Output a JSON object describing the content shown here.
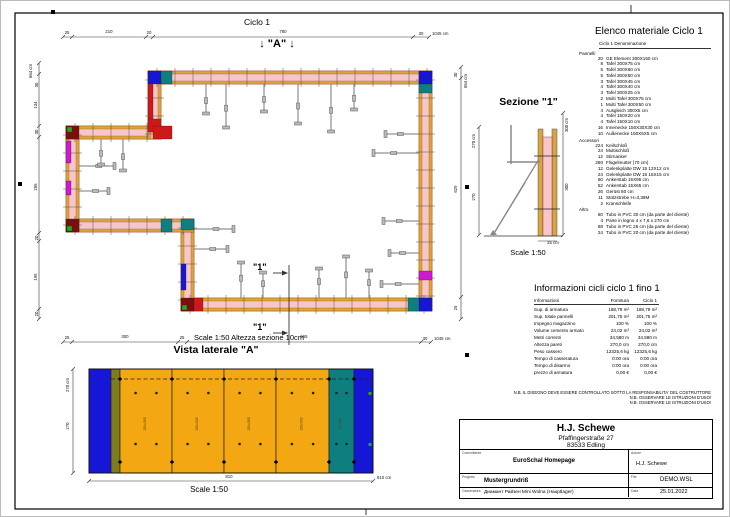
{
  "sheet": {
    "bg": "#ffffff",
    "frame_color": "#000000"
  },
  "plan": {
    "title": "Ciclo 1",
    "marker_a": "↓ \"A\" ↓",
    "cut_label": "\"1\"",
    "scale_note": "Scale 1:50   Altezza sezione 10cm",
    "colors": {
      "concrete": "#f7c6ca",
      "panel": "#e2a23b",
      "tick": "#555555"
    },
    "walls": [
      {
        "x": 147,
        "y": 70,
        "w": 284,
        "h": 13
      },
      {
        "x": 418,
        "y": 70,
        "w": 13,
        "h": 240
      },
      {
        "x": 180,
        "y": 297,
        "w": 251,
        "h": 13
      },
      {
        "x": 180,
        "y": 218,
        "w": 13,
        "h": 92
      },
      {
        "x": 65,
        "y": 218,
        "w": 128,
        "h": 13
      },
      {
        "x": 65,
        "y": 125,
        "w": 13,
        "h": 106
      },
      {
        "x": 65,
        "y": 125,
        "w": 95,
        "h": 13
      },
      {
        "x": 147,
        "y": 70,
        "w": 13,
        "h": 68
      }
    ],
    "corners": [
      {
        "x": 147,
        "y": 70,
        "w": 13,
        "h": 13,
        "c": "#1717d2"
      },
      {
        "x": 160,
        "y": 70,
        "w": 11,
        "h": 13,
        "c": "#0e7f7f"
      },
      {
        "x": 418,
        "y": 70,
        "w": 13,
        "h": 13,
        "c": "#1717d2"
      },
      {
        "x": 418,
        "y": 83,
        "w": 13,
        "h": 9,
        "c": "#0e7f7f"
      },
      {
        "x": 418,
        "y": 297,
        "w": 13,
        "h": 13,
        "c": "#1717d2"
      },
      {
        "x": 407,
        "y": 297,
        "w": 11,
        "h": 13,
        "c": "#0e7f7f"
      },
      {
        "x": 147,
        "y": 83,
        "w": 5,
        "h": 42,
        "c": "#d01818"
      },
      {
        "x": 147,
        "y": 118,
        "w": 13,
        "h": 13,
        "c": "#d01818"
      },
      {
        "x": 152,
        "y": 125,
        "w": 19,
        "h": 13,
        "c": "#d01818"
      },
      {
        "x": 65,
        "y": 125,
        "w": 13,
        "h": 13,
        "c": "#7e0d0d"
      },
      {
        "x": 66,
        "y": 126,
        "w": 5,
        "h": 5,
        "c": "#1faa1f"
      },
      {
        "x": 65,
        "y": 140,
        "w": 5,
        "h": 22,
        "c": "#d018d0"
      },
      {
        "x": 65,
        "y": 180,
        "w": 5,
        "h": 14,
        "c": "#d018d0"
      },
      {
        "x": 65,
        "y": 218,
        "w": 13,
        "h": 13,
        "c": "#7e0d0d"
      },
      {
        "x": 66,
        "y": 225,
        "w": 5,
        "h": 5,
        "c": "#1faa1f"
      },
      {
        "x": 180,
        "y": 218,
        "w": 13,
        "h": 11,
        "c": "#0e7f7f"
      },
      {
        "x": 160,
        "y": 218,
        "w": 11,
        "h": 13,
        "c": "#0e7f7f"
      },
      {
        "x": 180,
        "y": 263,
        "w": 5,
        "h": 26,
        "c": "#1717d2"
      },
      {
        "x": 180,
        "y": 297,
        "w": 13,
        "h": 13,
        "c": "#7e0d0d"
      },
      {
        "x": 181,
        "y": 304,
        "w": 5,
        "h": 5,
        "c": "#1faa1f"
      },
      {
        "x": 193,
        "y": 297,
        "w": 9,
        "h": 13,
        "c": "#d01818"
      },
      {
        "x": 418,
        "y": 270,
        "w": 13,
        "h": 9,
        "c": "#d018d0"
      }
    ],
    "props": [
      {
        "x": 205,
        "y": 83,
        "dir": "d",
        "len": 30
      },
      {
        "x": 225,
        "y": 83,
        "dir": "d",
        "len": 44
      },
      {
        "x": 263,
        "y": 83,
        "dir": "d",
        "len": 28
      },
      {
        "x": 297,
        "y": 83,
        "dir": "d",
        "len": 40
      },
      {
        "x": 330,
        "y": 83,
        "dir": "d",
        "len": 48
      },
      {
        "x": 353,
        "y": 83,
        "dir": "d",
        "len": 26
      },
      {
        "x": 418,
        "y": 133,
        "dir": "l",
        "len": 34
      },
      {
        "x": 418,
        "y": 152,
        "dir": "l",
        "len": 46
      },
      {
        "x": 418,
        "y": 220,
        "dir": "l",
        "len": 36
      },
      {
        "x": 418,
        "y": 252,
        "dir": "l",
        "len": 30
      },
      {
        "x": 418,
        "y": 283,
        "dir": "l",
        "len": 38
      },
      {
        "x": 240,
        "y": 297,
        "dir": "u",
        "len": 36
      },
      {
        "x": 262,
        "y": 297,
        "dir": "u",
        "len": 26
      },
      {
        "x": 318,
        "y": 297,
        "dir": "u",
        "len": 30
      },
      {
        "x": 345,
        "y": 297,
        "dir": "u",
        "len": 42
      },
      {
        "x": 368,
        "y": 297,
        "dir": "u",
        "len": 28
      },
      {
        "x": 78,
        "y": 165,
        "dir": "r",
        "len": 36
      },
      {
        "x": 78,
        "y": 190,
        "dir": "r",
        "len": 30
      },
      {
        "x": 100,
        "y": 138,
        "dir": "d",
        "len": 26
      },
      {
        "x": 122,
        "y": 138,
        "dir": "d",
        "len": 32
      },
      {
        "x": 193,
        "y": 228,
        "dir": "r",
        "len": 40
      },
      {
        "x": 193,
        "y": 248,
        "dir": "r",
        "len": 34
      }
    ],
    "dim_chains": [
      {
        "dir": "h",
        "x1": 62,
        "x2": 428,
        "y": 36,
        "ticks": [
          62,
          71,
          145,
          152,
          412,
          428
        ],
        "labels": [
          {
            "t": "25",
            "x": 66,
            "y": 33
          },
          {
            "t": "210",
            "x": 108,
            "y": 32
          },
          {
            "t": "20",
            "x": 148,
            "y": 33
          },
          {
            "t": "780",
            "x": 282,
            "y": 32
          },
          {
            "t": "30",
            "x": 420,
            "y": 34
          },
          {
            "t": "1045 cm",
            "x": 431,
            "y": 34,
            "anchor": "start"
          }
        ]
      },
      {
        "dir": "h",
        "x1": 62,
        "x2": 430,
        "y": 341,
        "ticks": [
          62,
          71,
          177,
          186,
          420,
          430
        ],
        "labels": [
          {
            "t": "25",
            "x": 66,
            "y": 338
          },
          {
            "t": "300",
            "x": 124,
            "y": 337
          },
          {
            "t": "25",
            "x": 181,
            "y": 338
          },
          {
            "t": "665",
            "x": 303,
            "y": 337
          },
          {
            "t": "30",
            "x": 424,
            "y": 339
          },
          {
            "t": "1045 cm",
            "x": 433,
            "y": 339,
            "anchor": "start"
          }
        ]
      },
      {
        "dir": "v",
        "x": 38,
        "y1": 62,
        "y2": 318,
        "ticks": [
          62,
          73,
          125,
          136,
          232,
          240,
          308,
          318
        ],
        "labels": [
          {
            "t": "664 cm",
            "x": 31,
            "y": 70
          },
          {
            "t": "30",
            "x": 37,
            "y": 84
          },
          {
            "t": "134",
            "x": 36,
            "y": 104
          },
          {
            "t": "30",
            "x": 37,
            "y": 131
          },
          {
            "t": "255",
            "x": 36,
            "y": 186
          },
          {
            "t": "20",
            "x": 37,
            "y": 237
          },
          {
            "t": "195",
            "x": 36,
            "y": 276
          },
          {
            "t": "20",
            "x": 37,
            "y": 313
          }
        ]
      },
      {
        "dir": "v",
        "x": 460,
        "y1": 66,
        "y2": 318,
        "ticks": [
          66,
          77,
          296,
          318
        ],
        "labels": [
          {
            "t": "654 cm",
            "x": 466,
            "y": 80
          },
          {
            "t": "30",
            "x": 456,
            "y": 74
          },
          {
            "t": "629",
            "x": 456,
            "y": 188
          },
          {
            "t": "25",
            "x": 456,
            "y": 307
          }
        ]
      }
    ],
    "cut": {
      "x": 288,
      "y1": 264,
      "y2": 344
    }
  },
  "section": {
    "title": "Sezione \"1\"",
    "scale": "Scale 1:50",
    "dims": {
      "left_total": "270 cm",
      "left_seg": "270",
      "right_total": "300 cm",
      "right_seg": "300",
      "bottom": "25 cm"
    }
  },
  "side_view": {
    "title": "Vista laterale \"A\"",
    "scale": "Scale 1:50",
    "dims": {
      "bottom_center": "810",
      "bottom_total": "810 cm",
      "left_total": "270 cm",
      "left_seg": "270"
    },
    "panels": [
      {
        "x": 88,
        "w": 22,
        "color": "#1616d6",
        "label": ""
      },
      {
        "x": 110,
        "w": 9,
        "color": "#7d7d20",
        "label": ""
      },
      {
        "x": 119,
        "w": 52,
        "color": "#f3a712",
        "label": "150x300"
      },
      {
        "x": 171,
        "w": 52,
        "color": "#f3a712",
        "label": "150x300"
      },
      {
        "x": 223,
        "w": 52,
        "color": "#f3a712",
        "label": "150x300"
      },
      {
        "x": 275,
        "w": 53,
        "color": "#f3a712",
        "label": "150x300"
      },
      {
        "x": 328,
        "w": 25,
        "color": "#0e7f7f",
        "label": "75x300"
      },
      {
        "x": 353,
        "w": 19,
        "color": "#1616d6",
        "label": ""
      }
    ]
  },
  "material_list": {
    "title": "Elenco materiale  Ciclo 1",
    "subheader": "Ciclo 1   Denominazione",
    "groups": [
      {
        "name": "Pannelli",
        "items": [
          [
            "20",
            "GE Element 300X150 cm"
          ],
          [
            "8",
            "Tafel 300X75 cm"
          ],
          [
            "5",
            "Tafel 300X60 cm"
          ],
          [
            "5",
            "Tafel 300X50 cm"
          ],
          [
            "3",
            "Tafel 300X45 cm"
          ],
          [
            "4",
            "Tafel 300X40 cm"
          ],
          [
            "3",
            "Tafel 300X25 cm"
          ],
          [
            "2",
            "Multi Tafel 300X75 cm"
          ],
          [
            "1",
            "Multi Tafel 300X50 cm"
          ],
          [
            "4",
            "Ausgleich 300X5 cm"
          ],
          [
            "4",
            "Tafel 150X20 cm"
          ],
          [
            "4",
            "Tafel 150X10 cm"
          ],
          [
            "16",
            "Innenecke 150X30X30 cm"
          ],
          [
            "10",
            "Außenecke 150X5X5 cm"
          ]
        ]
      },
      {
        "name": "Accessori",
        "items": [
          [
            "224",
            "Keilschloß"
          ],
          [
            "24",
            "Multischloß"
          ],
          [
            "12",
            "Stirnanker"
          ],
          [
            "280",
            "Flügelmutter (70 cm)"
          ],
          [
            "12",
            "Gelenkplatte DW 15 12X12 cm"
          ],
          [
            "24",
            "Gelenkplatte DW 15 15X15 cm"
          ],
          [
            "60",
            "Ankerstab 15X95 cm"
          ],
          [
            "52",
            "Ankerstab 15X65 cm"
          ],
          [
            "26",
            "Gerüst 60 cm"
          ],
          [
            "11",
            "Stützstrebe H=3,39M"
          ],
          [
            "2",
            "Kranschleife"
          ]
        ]
      },
      {
        "name": "Altro",
        "items": [
          [
            "60",
            "Tubo in PVC 30 cm (da parte del cliente)"
          ],
          [
            "4",
            "Parte in legno 4 x 7,6 x 270 cm"
          ],
          [
            "68",
            "Tubo in PVC 25 cm (da parte del cliente)"
          ],
          [
            "24",
            "Tubo in PVC 20 cm (da parte del cliente)"
          ]
        ]
      }
    ]
  },
  "cycle_info": {
    "title": "Informazioni cicli  ciclo 1 fino 1",
    "columns": [
      "Informazioni",
      "Fornitura",
      "Ciclo 1"
    ],
    "rows": [
      [
        "Sup. di armatura",
        "188,79 m²",
        "188,79 m²"
      ],
      [
        "Sup. totale pannelli",
        "201,75 m²",
        "201,75 m²"
      ],
      [
        "Impegno magazzino",
        "100 %",
        "100 %"
      ],
      [
        "Volume cemento armato",
        "24,02 m³",
        "24,02 m³"
      ],
      [
        "Metri correnti",
        "34,580 m",
        "34,580 m"
      ],
      [
        "Altezza pareti",
        "270,0 cm",
        "270,0 cm"
      ],
      [
        "Peso cassero",
        "12325,6 kg",
        "12325,6 kg"
      ],
      [
        "Tempo di casseratura",
        "0:00 ora",
        "0:00 ora"
      ],
      [
        "Tempo di disarmo",
        "0:00 ora",
        "0:00 ora"
      ],
      [
        "prezzo di armatura",
        "0,00 €",
        "0,00 €"
      ]
    ]
  },
  "notes": [
    "N.B. IL DISEGNO DEVE ESSERE CONTROLLATO SOTTO LA RESPONSABILITA' DEL COSTRUTTORE",
    "N.B. OSSERVARE LE ISTRUZIONI D'USO!",
    "N.B. OSSERVARE LE ISTRUZIONI D'USO!"
  ],
  "title_block": {
    "company": "H.J. Schewe",
    "address1": "Pfaffingerstraße 27",
    "address2": "83533 Edling",
    "committente_label": "Committente",
    "committente": "EuroSchal Homepage",
    "autore_label": "Autore",
    "autore": "H.J. Schewe",
    "progetto_label": "Progetto",
    "progetto": "Mustergrundriß",
    "file_label": "File",
    "file": "DEMO.WSL",
    "casseratura_label": "Casseratura",
    "casseratura": "Диамант Райзен Mini Wolna (Hauptlager)",
    "data_label": "Data",
    "data": "25.01.2022"
  }
}
